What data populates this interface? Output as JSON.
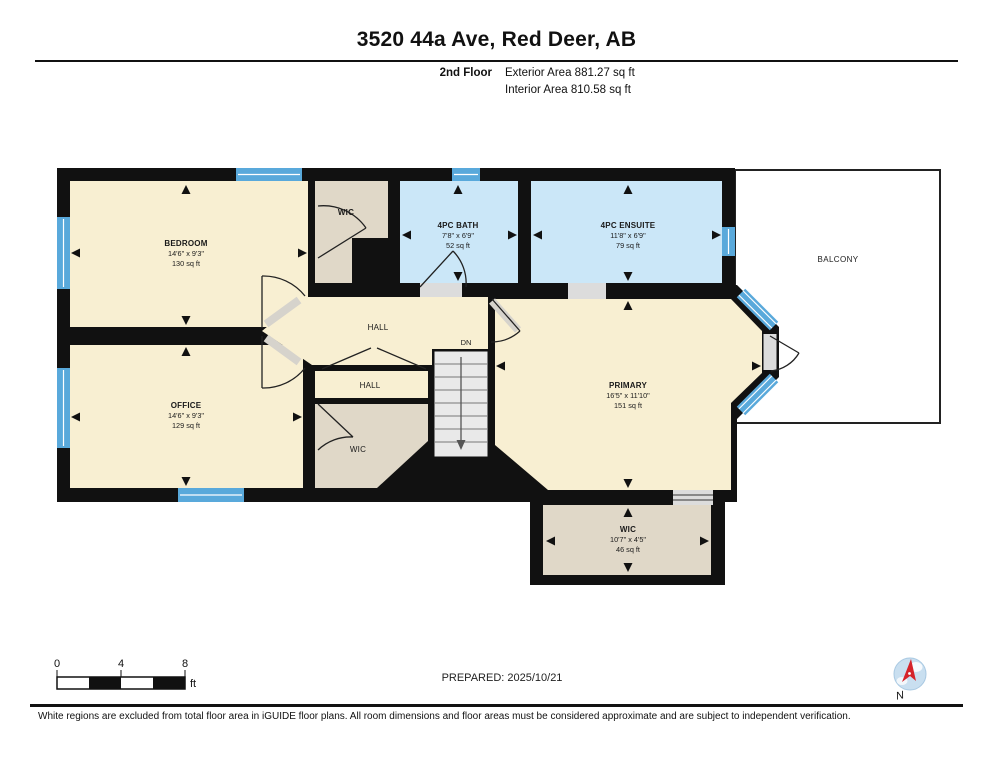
{
  "header": {
    "title": "3520 44a Ave, Red Deer, AB",
    "floor_label": "2nd Floor",
    "exterior_area": "Exterior Area 881.27 sq ft",
    "interior_area": "Interior Area 810.58 sq ft"
  },
  "rooms": {
    "bedroom": {
      "name": "BEDROOM",
      "dims": "14'6\" x 9'3\"",
      "area": "130 sq ft"
    },
    "wic_top": {
      "name": "WIC"
    },
    "bath": {
      "name": "4PC BATH",
      "dims": "7'8\" x 6'9\"",
      "area": "52 sq ft"
    },
    "ensuite": {
      "name": "4PC ENSUITE",
      "dims": "11'8\" x 6'9\"",
      "area": "79 sq ft"
    },
    "balcony": {
      "name": "BALCONY"
    },
    "hall_upper": {
      "name": "HALL"
    },
    "hall_lower": {
      "name": "HALL"
    },
    "stairs": {
      "label": "DN"
    },
    "office": {
      "name": "OFFICE",
      "dims": "14'6\" x 9'3\"",
      "area": "129 sq ft"
    },
    "wic_mid": {
      "name": "WIC"
    },
    "primary": {
      "name": "PRIMARY",
      "dims": "16'5\" x 11'10\"",
      "area": "151 sq ft"
    },
    "wic_bottom": {
      "name": "WIC",
      "dims": "10'7\" x 4'5\"",
      "area": "46 sq ft"
    }
  },
  "footer": {
    "scale": {
      "t0": "0",
      "t4": "4",
      "t8": "8",
      "unit": "ft"
    },
    "prepared": "PREPARED: 2025/10/21",
    "compass_label": "N"
  },
  "disclaimer": "White regions are excluded from total floor area in iGUIDE floor plans. All room dimensions and floor areas must be considered approximate and are subject to independent verification.",
  "colors": {
    "wall": "#111111",
    "room_cream": "#F8EFD2",
    "room_beige": "#E0D8C8",
    "room_blue": "#CBE7F8",
    "window_blue": "#59A9DB",
    "stairs_grey": "#E9E9E9",
    "opening_grey": "#DCDCDC",
    "compass_red": "#D5232A",
    "compass_blue": "#C9DFF0"
  }
}
